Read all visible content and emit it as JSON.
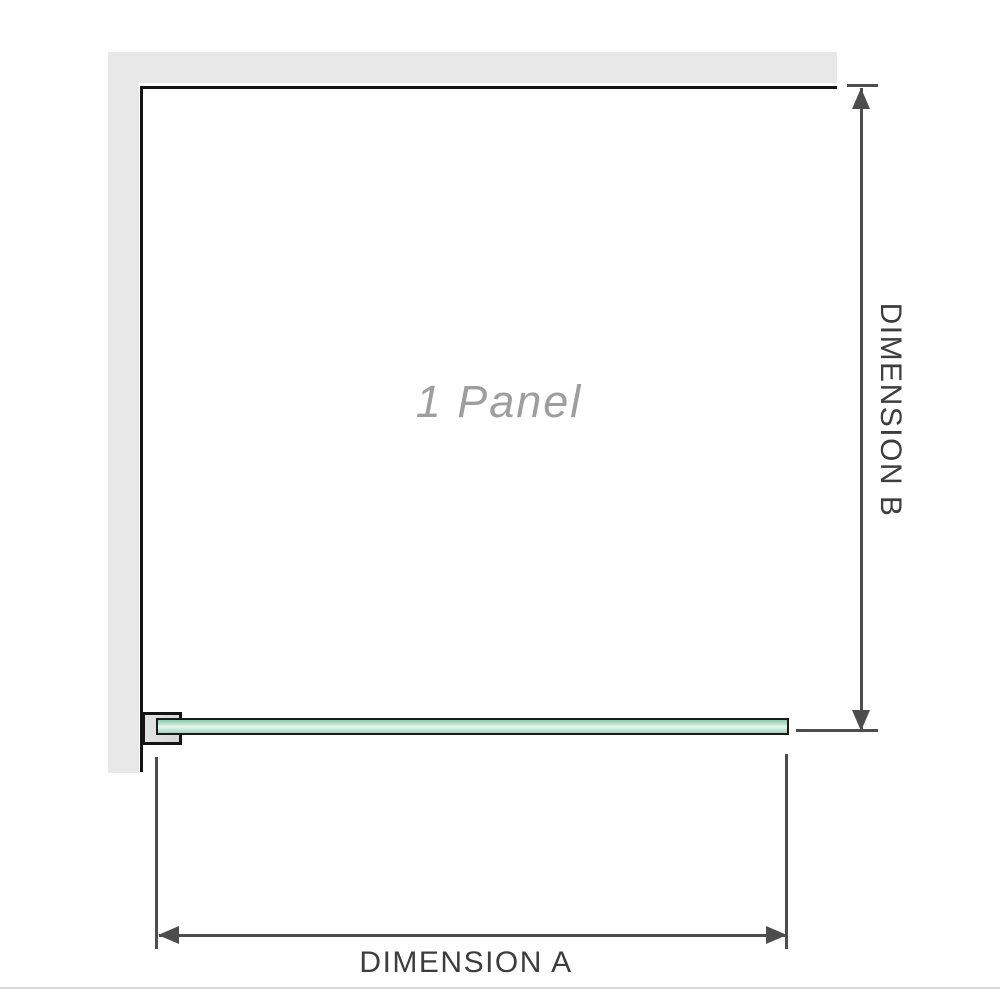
{
  "diagram": {
    "title": "shower-screen-1-panel-dimension-diagram",
    "panel_label": "1 Panel",
    "dimension_a_label": "DIMENSION A",
    "dimension_b_label": "DIMENSION B"
  },
  "colors": {
    "wall_gray": "#e8e8e8",
    "frame_outline": "#141414",
    "glass_green": "#a9dcc0",
    "glass_highlight": "#e9f7ef",
    "bracket_fill": "#dcdcdc",
    "dimension_line_gray": "#4d4d4d",
    "dimension_text_gray": "#3d3d3d",
    "panel_text_gray": "#9e9e9e",
    "bottom_border_gray": "#d9d9d6"
  },
  "icons": {
    "arrow_up": "dimension-b top arrowhead",
    "arrow_down": "dimension-b bottom arrowhead",
    "arrow_left": "dimension-a left arrowhead",
    "arrow_right": "dimension-a right arrowhead"
  }
}
